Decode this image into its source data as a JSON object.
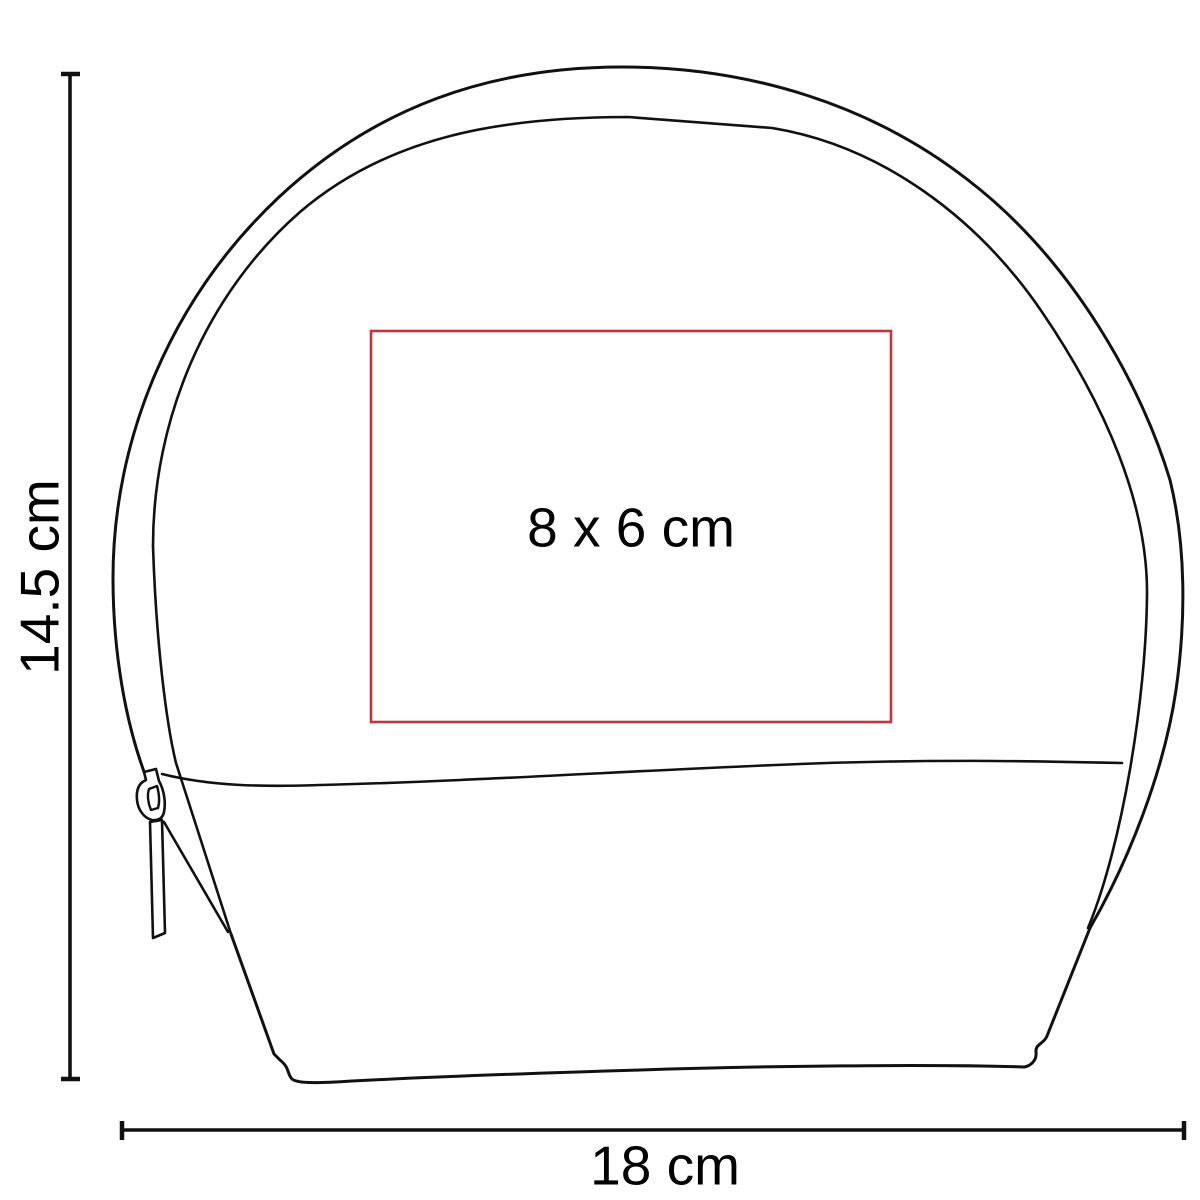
{
  "diagram": {
    "kind": "product-print-area-dimension-diagram",
    "labels": {
      "height": "14.5 cm",
      "width": "18 cm",
      "print_area": "8 x 6 cm"
    },
    "colors": {
      "outline": "#111111",
      "print_area_border": "#c13440",
      "text": "#000000",
      "background": "#ffffff"
    }
  }
}
